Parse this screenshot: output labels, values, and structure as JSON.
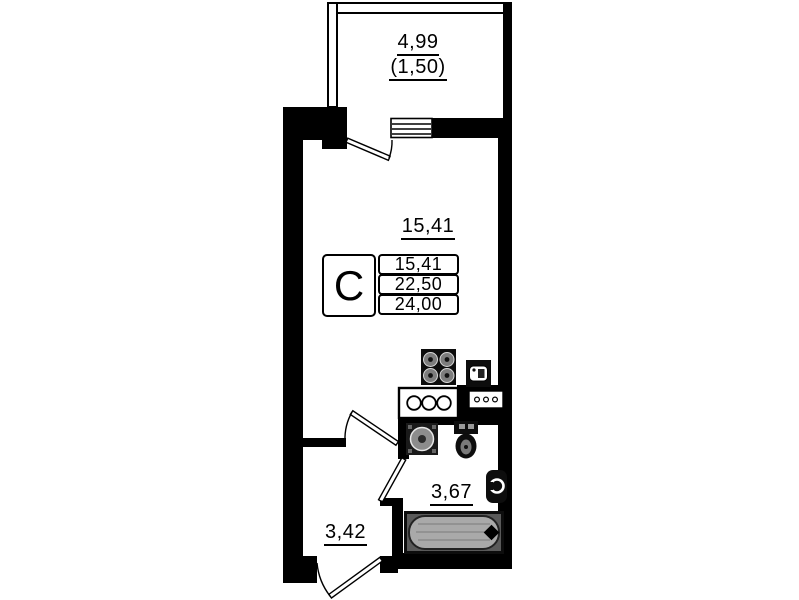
{
  "plan_type": "floor-plan",
  "labels": {
    "balcony_area": "4,99",
    "balcony_area_reduced": "(1,50)",
    "room_area": "15,41",
    "bathroom_area": "3,67",
    "hallway_area": "3,42"
  },
  "legend": {
    "letter": "С",
    "rows": [
      "15,41",
      "22,50",
      "24,00"
    ]
  },
  "fixtures": [
    "stove",
    "kitchen-counter",
    "small-appliance",
    "vent-grille",
    "washbasin",
    "toilet",
    "towel-warmer",
    "bathtub",
    "window",
    "balcony-door",
    "room-door",
    "bathroom-door",
    "entrance-door"
  ],
  "colors": {
    "wall": "#000000",
    "background": "#ffffff",
    "tub_fill": "#a9a9a9"
  }
}
